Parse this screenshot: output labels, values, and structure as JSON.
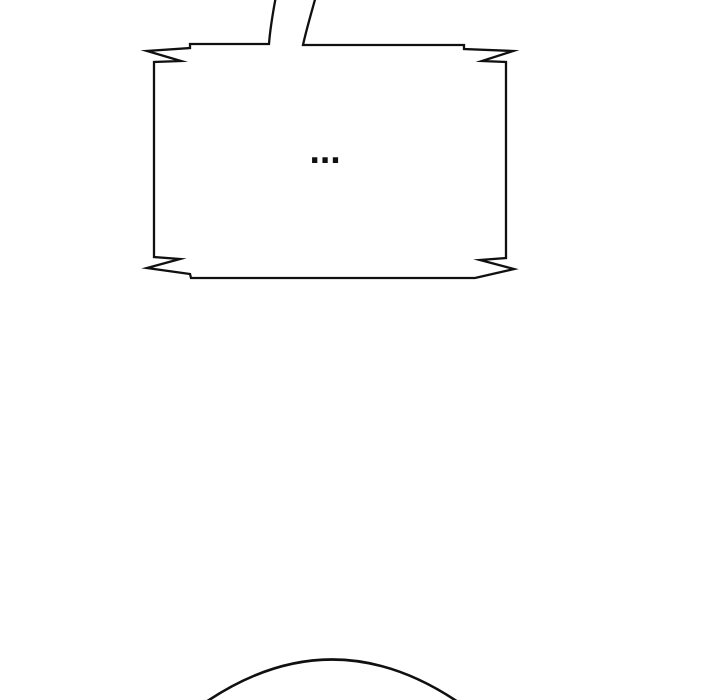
{
  "canvas": {
    "background": "#ffffff",
    "ink": "#101010"
  },
  "bubble": {
    "text": "...",
    "shape": "rectangular speech bubble with jagged lightning-notch corners and open tail pointing up out of frame"
  },
  "figure": {
    "shape": "top arc of character head entering from bottom edge"
  }
}
